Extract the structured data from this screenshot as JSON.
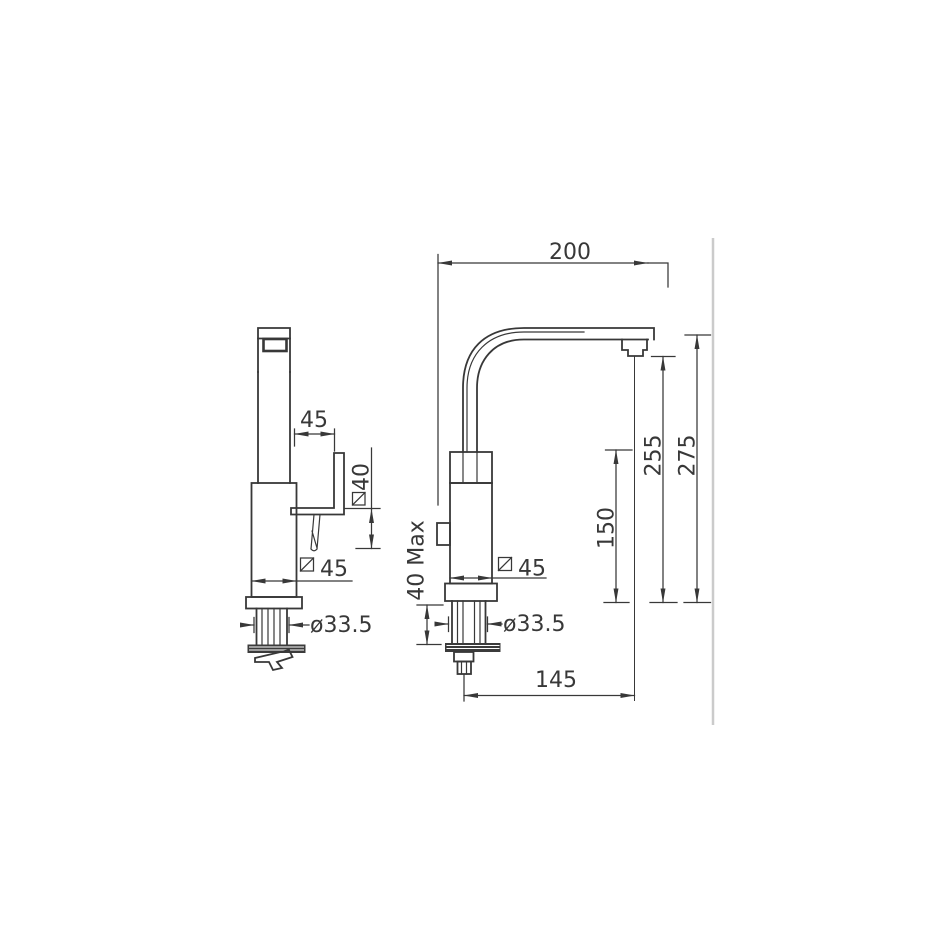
{
  "page": {
    "background": "#ffffff"
  },
  "drawing": {
    "colors": {
      "line": "#383838",
      "text": "#383838",
      "frame_line": "#cbcbcb",
      "plate_fill": "#3b3b3b",
      "hatch": "#ffffff"
    },
    "front_view": {
      "dims": {
        "handle_reach": "45",
        "handle_height": "40",
        "body_width": "45",
        "shank_diameter": "ø33.5"
      }
    },
    "side_view": {
      "dims": {
        "spout_reach": "200",
        "overall_height": "275",
        "spout_outlet_height": "255",
        "body_top_height": "150",
        "max_deck_thickness": "40 Max",
        "body_width": "45",
        "shank_diameter": "ø33.5",
        "outlet_offset": "145"
      }
    }
  }
}
